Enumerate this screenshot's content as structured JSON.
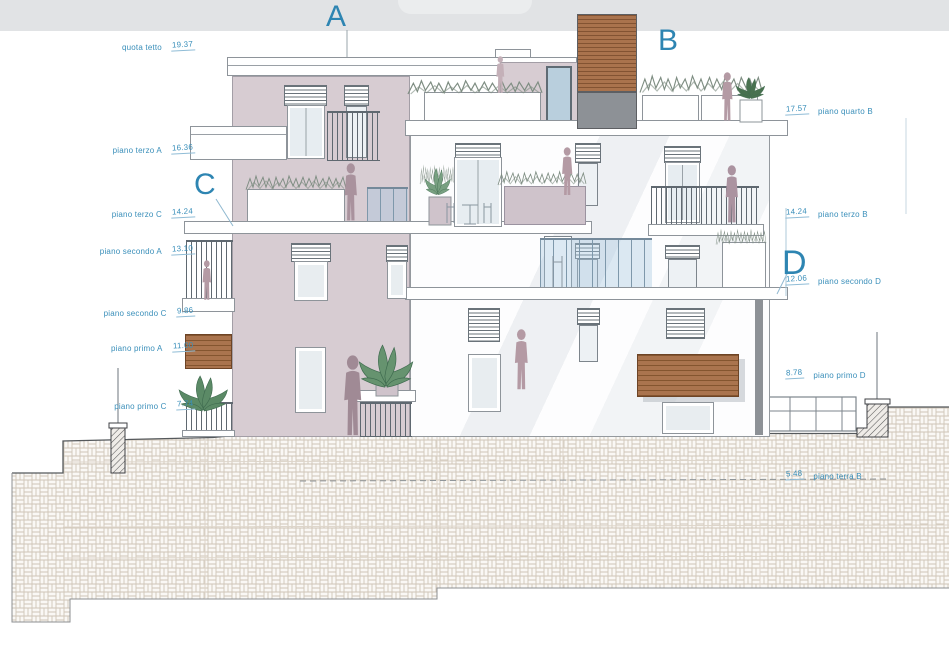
{
  "drawing": {
    "type": "architectural elevation section",
    "section_letters": {
      "a": "A",
      "b": "B",
      "c": "C",
      "d": "D"
    },
    "left_labels": [
      {
        "name": "quota tetto",
        "value": "19.37"
      },
      {
        "name": "piano terzo A",
        "value": "16.36"
      },
      {
        "name": "piano terzo C",
        "value": "14.24"
      },
      {
        "name": "piano secondo A",
        "value": "13.10"
      },
      {
        "name": "piano secondo C",
        "value": "9.86"
      },
      {
        "name": "piano primo A",
        "value": "11.00"
      },
      {
        "name": "piano primo C",
        "value": "7.74"
      }
    ],
    "right_labels": [
      {
        "value": "17.57",
        "name": "piano quarto B"
      },
      {
        "value": "14.24",
        "name": "piano terzo B"
      },
      {
        "value": "12.06",
        "name": "piano secondo D"
      },
      {
        "value": "8.78",
        "name": "piano primo D"
      },
      {
        "value": "5.48",
        "name": "piano terra B"
      }
    ],
    "colors": {
      "label_blue": "#3a8fba",
      "letter_blue": "#2e85b2",
      "facade_mauve": "#d7ccd2",
      "wood_brown": "#aa744e",
      "hatch_tan": "#cfc5b7",
      "glass_blue": "#b9cfdd",
      "silhouette_mauve": "#ae97a2",
      "topband_gray": "#e1e3e5"
    }
  }
}
